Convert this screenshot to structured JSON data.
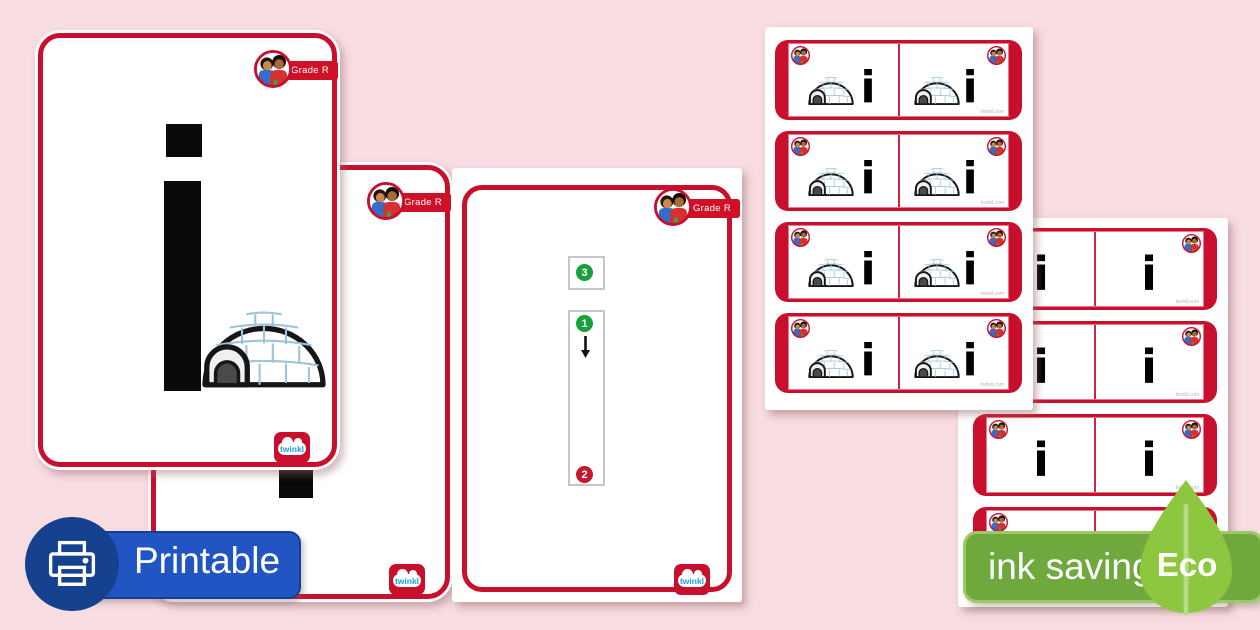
{
  "page": {
    "background": "#f7dce1",
    "description_colors": {
      "twinkl_red": "#c8102e",
      "grade_badge_red": "#cf1127",
      "step_green": "#18a03c",
      "step_red": "#c21a2c",
      "printable_blue": "#2155c4",
      "printable_circle_blue": "#16418f",
      "eco_banner_green": "#6fa93e",
      "eco_leaf_green": "#8dc63f",
      "twinkl_logo_blue": "#19a1e5",
      "letter_black": "#0a0a0a"
    }
  },
  "grade_badge": {
    "label": "Grade R"
  },
  "twinkl_logo": {
    "text": "twinkl"
  },
  "flashcards": {
    "letter": "i",
    "picture_name": "igloo",
    "watermark": "twinkl.com",
    "formation": {
      "step1": "1",
      "step2": "2",
      "step3": "3"
    },
    "picture_sheet_rows": 4,
    "letter_sheet_rows": 4
  },
  "overlay_badges": {
    "printable": {
      "label": "Printable"
    },
    "eco": {
      "label": "ink saving",
      "leaf_label": "Eco"
    }
  }
}
